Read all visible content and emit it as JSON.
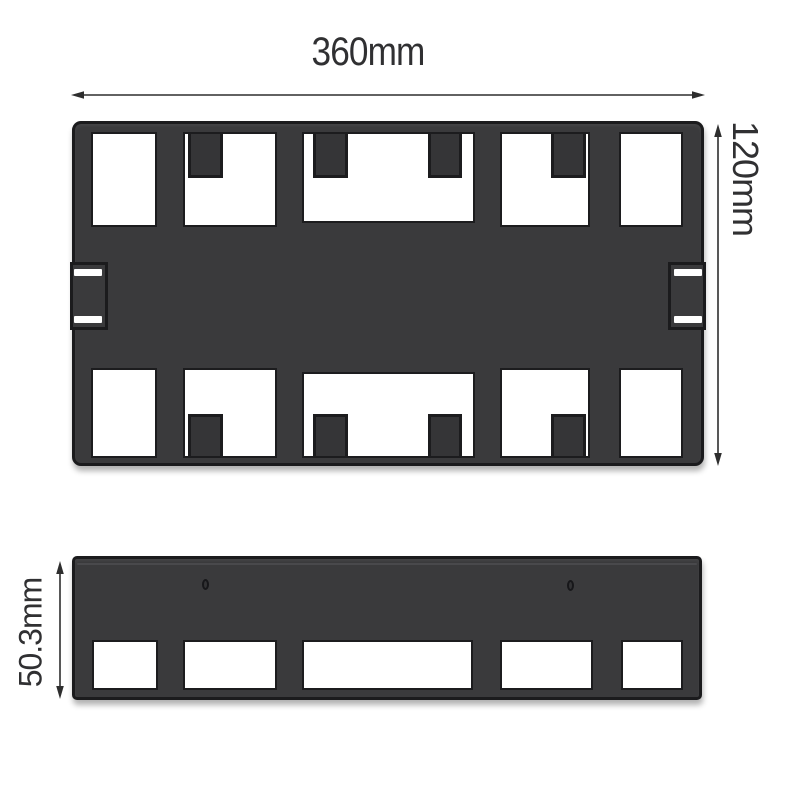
{
  "background": "#ffffff",
  "colors": {
    "plate_fill": "#3a3a3c",
    "plate_outline": "#1b1b1d",
    "cutout_fill": "#ffffff",
    "dimension_line": "#2e2e2e",
    "dimension_text": "#303032"
  },
  "dimensions": {
    "overall_width": {
      "label": "360mm"
    },
    "overall_height": {
      "label": "120mm"
    },
    "side_height": {
      "label": "50.3mm"
    }
  },
  "views": {
    "top_view": {
      "name": "top-view-plate",
      "top_edge_cutouts": 5,
      "bottom_edge_cutouts": 5,
      "top_edge_tabs": 4,
      "bottom_edge_tabs": 4,
      "side_clips": 2,
      "clip_slots_per_clip": 2
    },
    "side_view": {
      "name": "front-view-plate",
      "bottom_edge_cutouts": 5,
      "holes": 2
    }
  }
}
